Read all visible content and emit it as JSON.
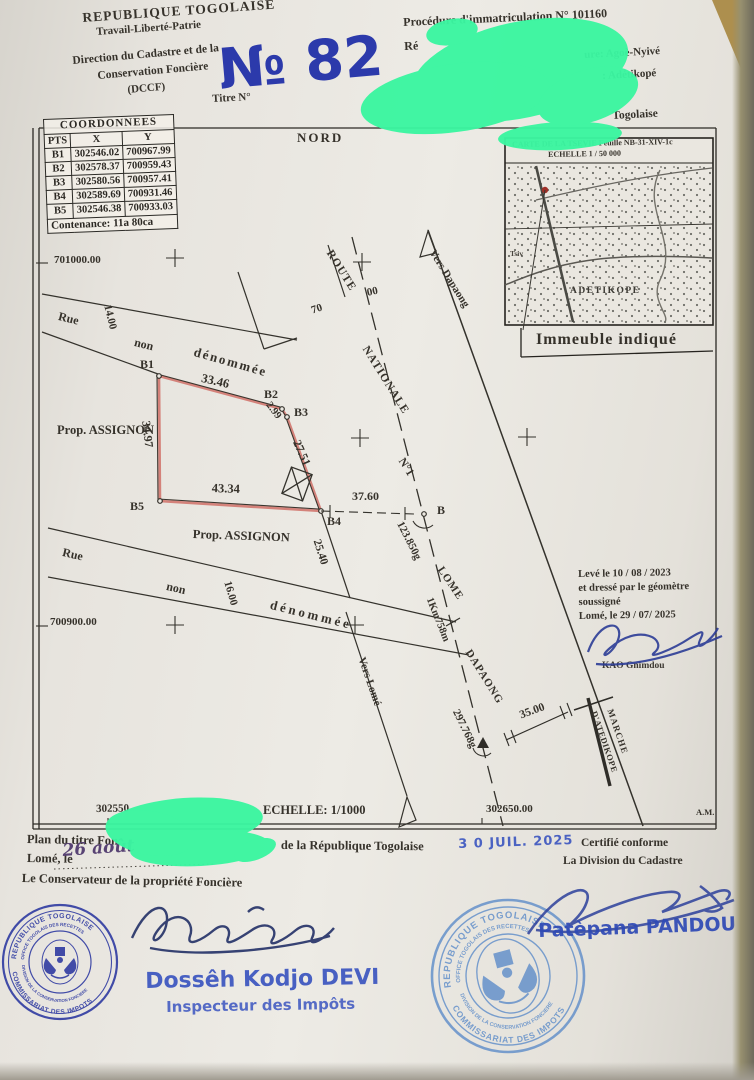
{
  "colors": {
    "ink_blue_handwritten_no": "#2c3aab",
    "stamp_blue_dark": "#2a36a0",
    "stamp_blue_light": "#5d8cc9",
    "blue_stamp_text": "#3b55c0",
    "redaction_green": "#3bf5a0",
    "parcel_pink": "#d4827a",
    "map_red_dot": "#a03028"
  },
  "header": {
    "republic": "REPUBLIQUE TOGOLAISE",
    "motto": "Travail-Liberté-Patrie",
    "direction_1": "Direction du Cadastre et de la",
    "direction_2": "Conservation Foncière",
    "direction_3": "(DCCF)",
    "title_number_handwritten": "№ 82",
    "titre_label": "Titre N°"
  },
  "registration": {
    "line1": "Procédure d'immatriculation N° 101160",
    "line2_fragment": "Ré",
    "line2_right_fragment": "ure: Agoè-Nyivé",
    "line3_right_fragment": ": Adétikopé",
    "line4_fragment": "Togolaise"
  },
  "coordinates_table": {
    "title": "COORDONNEES",
    "col_pts": "PTS",
    "col_x": "X",
    "col_y": "Y",
    "rows": [
      {
        "pt": "B1",
        "x": "302546.02",
        "y": "700967.99"
      },
      {
        "pt": "B2",
        "x": "302578.37",
        "y": "700959.43"
      },
      {
        "pt": "B3",
        "x": "302580.56",
        "y": "700957.41"
      },
      {
        "pt": "B4",
        "x": "302589.69",
        "y": "700931.46"
      },
      {
        "pt": "B5",
        "x": "302546.38",
        "y": "700933.03"
      }
    ],
    "contenance": "Contenance: 11a 80ca"
  },
  "map_inset": {
    "title": "CARTE DE LA TSEVIE Feuille NB-31-XIV-1c",
    "scale": "ECHELLE 1 / 50 000",
    "village": "Tsiv",
    "town": "ADETIKOPE",
    "caption": "Immeuble indiqué"
  },
  "plan": {
    "north": "NORD",
    "grid": {
      "y1": "701000.00",
      "y2": "700900.00",
      "x1": "302550",
      "x2": "302650.00",
      "corner": "A.M."
    },
    "scale": "ECHELLE: 1/1000",
    "street_top": {
      "rue": "Rue",
      "width": "14.00",
      "non": "non",
      "den": "dénommée"
    },
    "street_bottom": {
      "rue": "Rue",
      "width": "16.00",
      "non": "non",
      "den": "dénommée"
    },
    "owner1": "Prop. ASSIGNON",
    "owner2": "Prop. ASSIGNON",
    "parcel": {
      "p1": "B1",
      "p2": "B2",
      "p3": "B3",
      "p4": "B4",
      "p5": "B5",
      "dims": {
        "b1b2": "33.46",
        "b2b3": "2.99",
        "b3b4": "27.51",
        "b4b5": "43.34",
        "b5b1": "34.97"
      }
    },
    "road": {
      "name1": "ROUTE",
      "name2": "NATIONALE",
      "name3": "N°1",
      "ch1": "70",
      "ch2": "00",
      "vers_dapaong": "Vers Dapaong",
      "vers_lome": "Vers Lomé",
      "lome": "LOME",
      "dist": "1Km758m",
      "dapaong": "DAPAONG",
      "pt_b": "B",
      "angle_b": "123.850g",
      "angle_a": "297.768g",
      "tie": "37.60",
      "offset": "25.40"
    },
    "market": {
      "line1": "MARCHE",
      "line2": "D'ATEDIKOPE",
      "dim": "35.00"
    },
    "survey_note": [
      "Levé le 10 / 08 / 2023",
      "et dressé par le géomètre",
      "soussigné",
      "Lomé, le 29 / 07/ 2025"
    ],
    "surveyor": "KAO Gnimdou"
  },
  "footer": {
    "plan_line_left": "Plan du titre Fon",
    "plan_line_right": "de la République Togolaise",
    "lome_le": "Lomé, le",
    "handwritten_date": "26 août",
    "date_stamp": "3 0 JUIL. 2025",
    "certify1": "Certifié conforme",
    "certify2": "La Division du Cadastre",
    "conservateur": "Le Conservateur de la propriété Foncière",
    "stamp": {
      "ring_top": "REPUBLIQUE TOGOLAISE",
      "ring_bottom": "COMMISSARIAT DES IMPOTS",
      "ring_inner_top": "OFFICE TOGOLAIS DES RECETTES",
      "ring_inner_bottom": "DIVISION DE LA CONSERVATION FONCIERE"
    },
    "inspector_name": "Dossêh Kodjo DEVI",
    "inspector_title": "Inspecteur des Impôts",
    "director_name": "Patèpana PANDOU"
  }
}
